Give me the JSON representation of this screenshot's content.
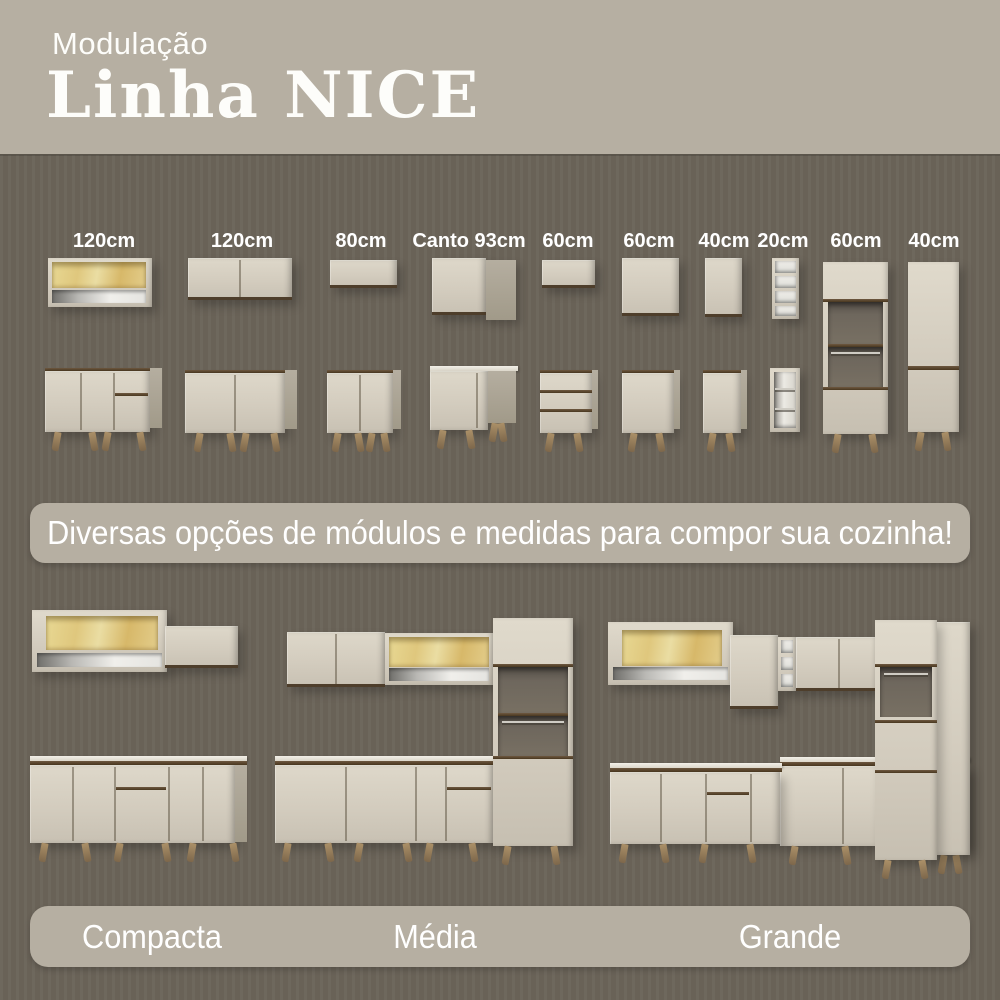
{
  "header": {
    "subtitle": "Modulação",
    "title": "Linha NICE"
  },
  "modules": {
    "labels": [
      "120cm",
      "120cm",
      "80cm",
      "Canto 93cm",
      "60cm",
      "60cm",
      "40cm",
      "20cm",
      "60cm",
      "40cm"
    ]
  },
  "banner": {
    "text": "Diversas opções de módulos e medidas para compor sua cozinha!"
  },
  "sets": [
    {
      "label": "Compacta"
    },
    {
      "label": "Média"
    },
    {
      "label": "Grande"
    }
  ],
  "colors": {
    "background": "#6b6459",
    "panel": "#b6afa2",
    "cabinet": "#d6cfc1",
    "wood_trim": "#5a4631",
    "glass": "#dfc57e",
    "legs": "#a28865",
    "text": "#ffffff"
  }
}
